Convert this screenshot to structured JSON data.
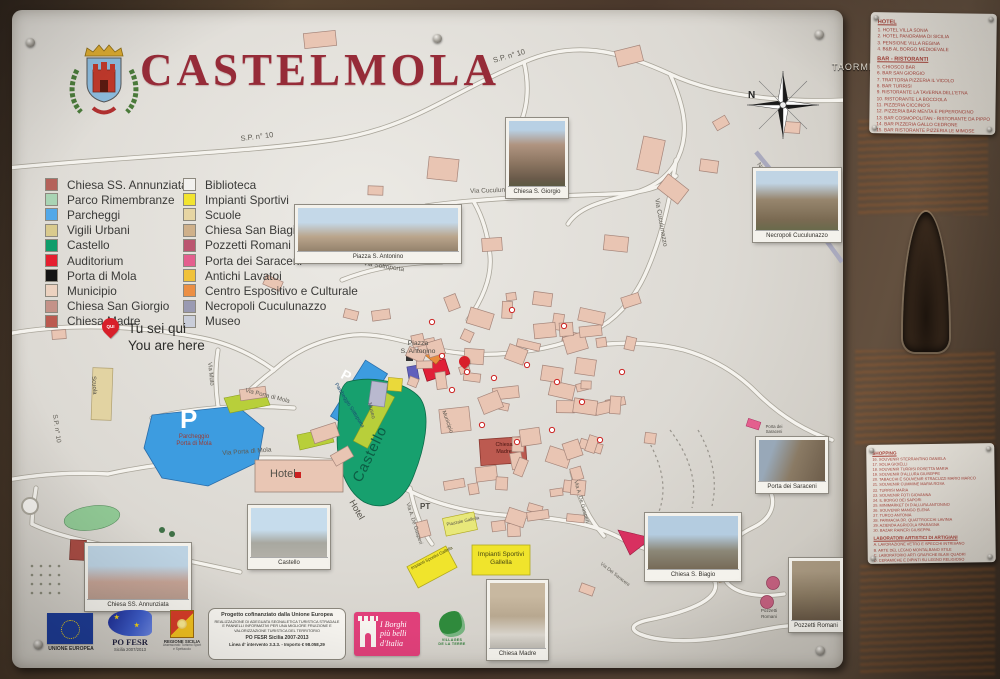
{
  "sign": {
    "title": "CASTELMOLA",
    "frame_direction_label": "TAORMINA",
    "compass_north": "N",
    "you_are_here": {
      "pin": "QUI",
      "line1": "Tu sei qui",
      "line2": "You are here"
    }
  },
  "legend": {
    "column1": [
      {
        "label": "Chiesa SS. Annunziata",
        "color": "#b5625a"
      },
      {
        "label": "Parco Rimembranze",
        "color": "#a9d4b4"
      },
      {
        "label": "Parcheggi",
        "color": "#52a8e8"
      },
      {
        "label": "Vigili Urbani",
        "color": "#d9ca8d"
      },
      {
        "label": "Castello",
        "color": "#0f9d6a"
      },
      {
        "label": "Auditorium",
        "color": "#e51f2f"
      },
      {
        "label": "Porta di Mola",
        "color": "#141414"
      },
      {
        "label": "Municipio",
        "color": "#ecd2c0"
      },
      {
        "label": "Chiesa San Giorgio",
        "color": "#c49288"
      },
      {
        "label": "Chiesa Madre",
        "color": "#bb5a50"
      }
    ],
    "column2": [
      {
        "label": "Biblioteca",
        "color": "#f2f1ee"
      },
      {
        "label": "Impianti Sportivi",
        "color": "#f2e430"
      },
      {
        "label": "Scuole",
        "color": "#e6d5a3"
      },
      {
        "label": "Chiesa San Biagio",
        "color": "#cfb08a"
      },
      {
        "label": "Pozzetti Romani",
        "color": "#bb5570"
      },
      {
        "label": "Porta dei Saraceni",
        "color": "#e45f8e"
      },
      {
        "label": "Antichi Lavatoi",
        "color": "#f0c23a"
      },
      {
        "label": "Centro Espositivo e Culturale",
        "color": "#ec8f44"
      },
      {
        "label": "Necropoli Cuculunazzo",
        "color": "#9a9ab2"
      },
      {
        "label": "Museo",
        "color": "#c9cdd9"
      }
    ]
  },
  "map": {
    "roads": {
      "sp10": "S.P. n° 10",
      "cuculunazzo": "Via Cuculunazzo",
      "sottoporta": "Via Sottoporta",
      "muto": "Via Muto",
      "porta_di_mola": "Via Porta di Mola",
      "de_gasperi": "Via A. De Gasperi",
      "dei_saraceni": "Via Dei Saraceni",
      "necropoli_path": "Necropoli Cuculunazzo"
    },
    "places": {
      "piazza_line1": "Piazza",
      "piazza_line2": "S. Antonino",
      "parking_p": "P",
      "parcheggio_mola_1": "Parcheggio",
      "parcheggio_mola_2": "Porta di Mola",
      "parcheggio_sottoporta": "Parcheggio Sottoporta",
      "castello": "Castello",
      "museo": "Museo",
      "municipio": "Municipio",
      "hotel": "Hotel",
      "pt": "PT",
      "scuola": "Scuola",
      "chiesa_madre_1": "Chiesa",
      "chiesa_madre_2": "Madre",
      "impianti_1": "Impianti Sportivi",
      "impianti_2": "Gallella",
      "impianti_small": "Impianti Sportivi Gallella",
      "piazzale": "Piazzale Gallella",
      "biagio_1": "Chiesa",
      "biagio_2": "S. Biagio",
      "pozzetti_1": "Pozzetti",
      "pozzetti_2": "Romani",
      "saraceni_1": "Porta dei",
      "saraceni_2": "Saraceni"
    },
    "photos": [
      {
        "caption": "Chiesa S. Giorgio"
      },
      {
        "caption": "Necropoli Cuculunazzo"
      },
      {
        "caption": "Piazza S. Antonino"
      },
      {
        "caption": "Chiesa SS. Annunziata"
      },
      {
        "caption": "Castello"
      },
      {
        "caption": "Chiesa S. Biagio"
      },
      {
        "caption": "Porta dei Saraceni"
      },
      {
        "caption": "Chiesa Madre"
      },
      {
        "caption": "Pozzetti Romani"
      }
    ]
  },
  "panels": {
    "hotel": {
      "heading": "HOTEL",
      "items": [
        "1.  HOTEL VILLA SONIA",
        "2.  HOTEL PANORAMA DI SICILIA",
        "3.  PENSIONE VILLA REGINA",
        "4.  B&B AL BORGO MEDIOEVALE"
      ]
    },
    "bar": {
      "heading": "BAR - RISTORANTI",
      "items": [
        "5.  CHIOSCO BAR",
        "6.  BAR SAN GIORGIO",
        "7.  TRATTORIA PIZZERIA IL VICOLO",
        "8.  BAR TURRISI",
        "9.  RISTORANTE LA TAVERNA DELL'ETNA",
        "10. RISTORANTE LA BOCCIOLA",
        "11. PIZZERIA CICCINO'S",
        "12. PIZZERIA BAR MENTA E PEPERONCINO",
        "13. BAR COSMOPOLITAN - RISTORANTE DA PIPPO",
        "14. BAR PIZZERIA GALLO CEDRONE",
        "15. BAR RISTORANTE PIZZERIA LE MIMOSE"
      ]
    },
    "shopping": {
      "heading": "SHOPPING",
      "items": [
        "16. SOUVENIR STERRANTINO DANIELA",
        "17. SOLIA GIOIELLI",
        "18. SOUVENIR TURRISI ROSETTA MARIA",
        "19. SOUVENIR D'ALLURA GIUSEPPE",
        "20. TABACCHI E SOUVENIR STRACUZZI MARIO MARCO",
        "21. SOUVENIR CUMMINE MARIA ROSA",
        "22. TURRISI MARIA",
        "23. SOUVENIR FOTI GIOVANNA",
        "24. IL BORGO DEI SAPORI",
        "25. MINIMARKET DI D'ALLURA ANTONINO",
        "26. SOUVENIR MANGO ELENA",
        "27. TURCO ANTONIA",
        "28. FARMACIA DR. QUATTROCCHI LAVINIA",
        "29. AZIENDA AGRICOLA SPARAGNA",
        "30. BAZAR RAINERI GIUSEPPA"
      ]
    },
    "laboratori": {
      "heading": "LABORATORI ARTISTICI DI ARTIGIANI",
      "items": [
        "A. LAVORAZIONE VETRO E SPECCHI INTRISANO",
        "B. ARTE DEL LEGNO MONTALBANO STILE",
        "C. LABORATORIO ARTI GRAFICHE BLASI QUADRI",
        "D. CERAMICHE E DIPINTI SU LEGNO RELIGIOSO",
        "E. LABORATORIO RESTAURO LAMPADARI",
        "F. RICEVITORIA E LABORATORIO ARTISTICO"
      ]
    }
  },
  "footer": {
    "eu": "UNIONE EUROPEA",
    "po_fesr_title": "PO FESR",
    "po_fesr_sub": "Sicilia 2007/2013",
    "regione_title": "REGIONE SICILIA",
    "regione_sub": "Assessorato Turismo Sport e Spettacolo",
    "project": {
      "line1": "Progetto cofinanziato dalla Unione Europea",
      "line2": "Realizzazione di adeguata segnaletica turistica stradale e pannelli informativi per una migliore fruizione e valorizzazione turistica del territorio",
      "line3": "PO FESR Sicilia 2007-2013",
      "line4": "Linea d' intervento 3.3.3. - Importo € 98.058,29"
    },
    "borghi": {
      "line1": "I Borghi",
      "line2": "più belli",
      "line3": "d'Italia"
    },
    "villages": {
      "line1": "VILLAGES",
      "line2": "DE LA TERRE"
    }
  }
}
